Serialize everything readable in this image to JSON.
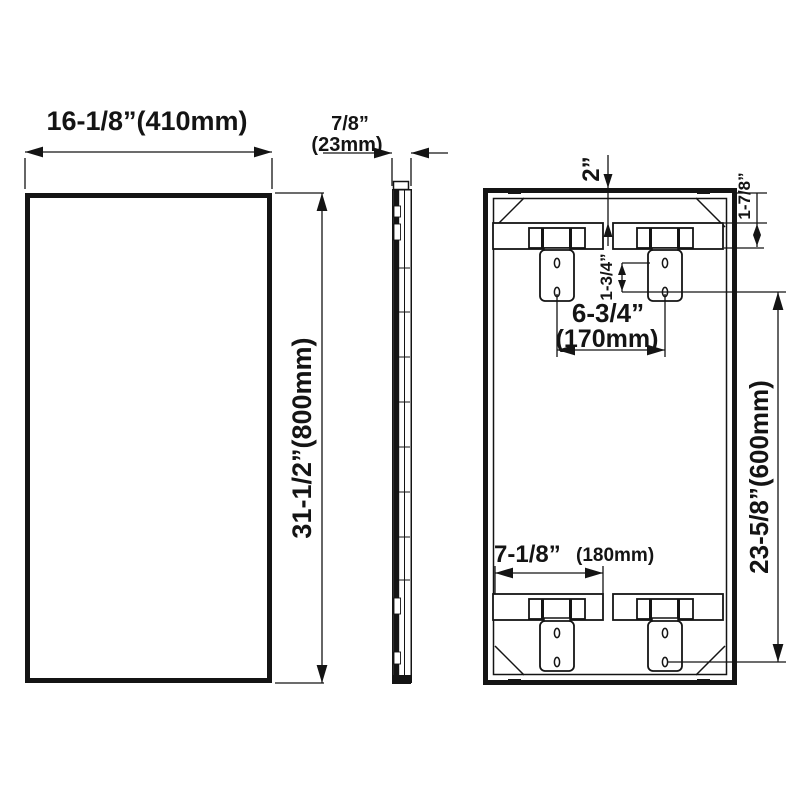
{
  "diagram": {
    "title": "Mirror installation dimension drawing",
    "front_view": {
      "width_label": "16-1/8”(410mm)",
      "height_label": "31-1/2”(800mm)"
    },
    "side_view": {
      "thickness_in": "7/8”",
      "thickness_mm": "(23mm)"
    },
    "back_view": {
      "top_edge_offset": "2”",
      "rail_height": "1-7/8”",
      "hole_spacing": "1-3/4”",
      "top_bracket_span_in": "6-3/4”",
      "top_bracket_span_mm": "(170mm)",
      "bottom_rail_width_in": "7-1/8”",
      "bottom_rail_width_mm": "(180mm)",
      "bracket_vertical_span": "23-5/8”(600mm)"
    },
    "line_color": "#141414",
    "background_color": "#ffffff"
  }
}
